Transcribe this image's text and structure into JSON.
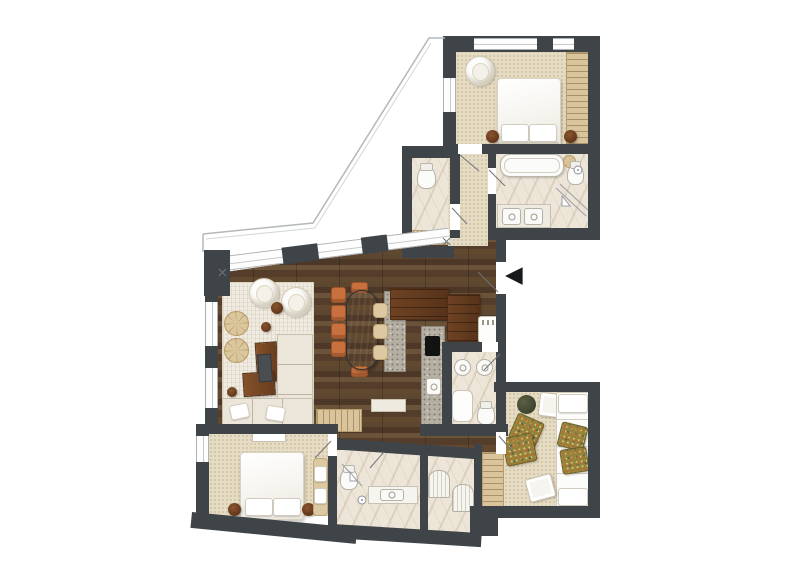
{
  "title": "Apartment floor plan (top-down interior rendering)",
  "entrance": {
    "arrow_symbol": "◀"
  },
  "palette": {
    "wall": "#3f4448",
    "wood_floor_dark": "#54402c",
    "carpet_beige": "#e6dcc3",
    "marble": "#ece5d8",
    "rug_cream": "#f0ebe0",
    "accent_orange": "#c8703e",
    "table_charcoal": "#3a3d40",
    "nightstand_brown": "#6e4123",
    "pouf_green": "#4b5036",
    "cushion_olive": "#96833c",
    "granite": "#b5afa3",
    "wardrobe_tan": "#d9c49c",
    "line_gray": "#9aa0a4"
  },
  "rooms": [
    {
      "id": "bedroom-master",
      "floor": "carpet"
    },
    {
      "id": "bathroom-master",
      "floor": "marble"
    },
    {
      "id": "wc",
      "floor": "marble"
    },
    {
      "id": "hallway",
      "floor": "carpet"
    },
    {
      "id": "entry",
      "floor": "wood"
    },
    {
      "id": "living-dining",
      "floor": "wood"
    },
    {
      "id": "kitchen",
      "floor": "wood"
    },
    {
      "id": "bathroom-center",
      "floor": "marble"
    },
    {
      "id": "bedroom-second",
      "floor": "carpet"
    },
    {
      "id": "bathroom-lower",
      "floor": "marble"
    },
    {
      "id": "lounge",
      "floor": "carpet"
    },
    {
      "id": "terrace",
      "floor": "outline-only"
    }
  ],
  "furniture_icons": [
    "double-bed",
    "pillows",
    "nightstand",
    "round-lounge-chair",
    "wardrobe-with-hangers",
    "bathtub",
    "double-vanity-sinks",
    "toilet",
    "shower",
    "radiator",
    "oval-dining-table",
    "dining-chairs-orange",
    "kitchen-island",
    "bar-stools",
    "cooktop",
    "kitchen-cabinets",
    "washer-appliance",
    "sectional-sofa",
    "round-armchairs",
    "coffee-tables",
    "serving-tray",
    "segmented-poufs",
    "side-tables",
    "daybed",
    "patterned-floor-cushions",
    "green-pouf",
    "ottoman-trays",
    "bench",
    "tv-console",
    "wall-shelf",
    "entrance-arrow",
    "door-swing-lines",
    "balcony-outline",
    "window-glazing"
  ]
}
